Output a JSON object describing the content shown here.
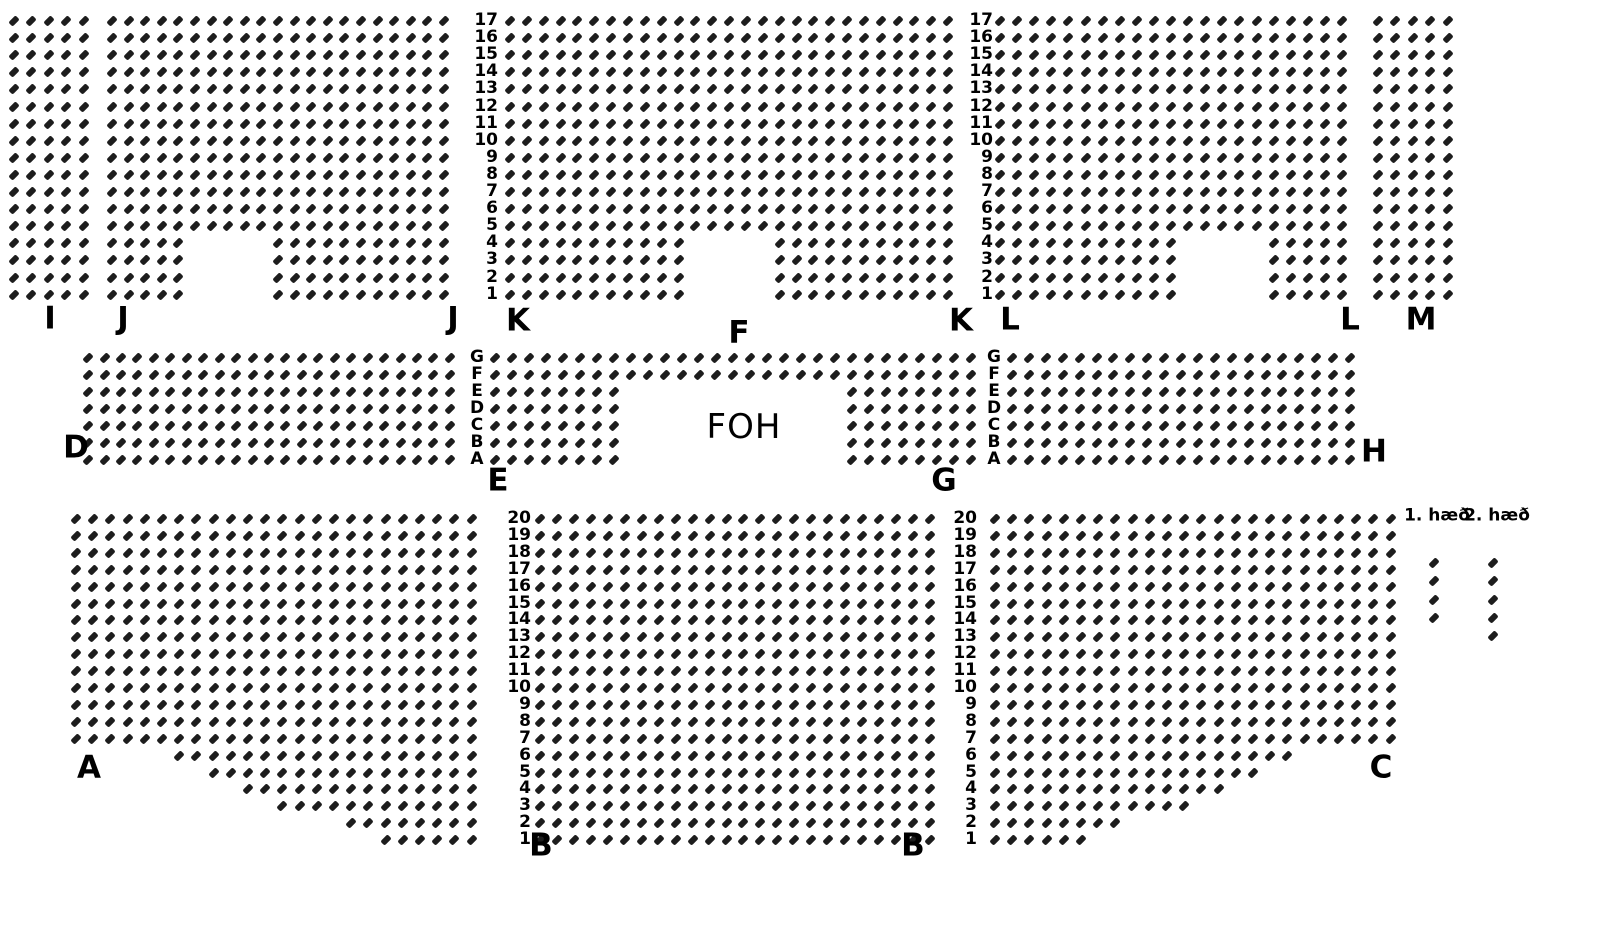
{
  "page": {
    "kind": "venue-seating-chart",
    "background_color": "#ffffff",
    "text_color": "#000000",
    "seat_color": "#1d1d1d"
  },
  "seat_map": {
    "seat_style": {
      "w": 10,
      "h": 6,
      "rotation_deg": -45
    },
    "sections": [
      {
        "name": "I",
        "x": 14,
        "y": 21,
        "cols": 5,
        "rows": 17,
        "dx": 17.4,
        "dy": 17.1,
        "gaps": []
      },
      {
        "name": "J",
        "x": 112,
        "y": 21,
        "cols": 21,
        "rows": 17,
        "dx": 16.6,
        "dy": 17.1,
        "gaps": [
          {
            "r0": 13,
            "r1": 16,
            "c0": 5,
            "c1": 9
          }
        ]
      },
      {
        "name": "K-F",
        "x": 510,
        "y": 21,
        "cols": 27,
        "rows": 17,
        "dx": 16.85,
        "dy": 17.1,
        "gaps": [
          {
            "r0": 13,
            "r1": 16,
            "c0": 11,
            "c1": 15
          }
        ]
      },
      {
        "name": "L",
        "x": 1000,
        "y": 21,
        "cols": 21,
        "rows": 17,
        "dx": 17.1,
        "dy": 17.1,
        "gaps": [
          {
            "r0": 13,
            "r1": 16,
            "c0": 11,
            "c1": 15
          }
        ]
      },
      {
        "name": "M",
        "x": 1378,
        "y": 21,
        "cols": 5,
        "rows": 17,
        "dx": 17.4,
        "dy": 17.1,
        "gaps": []
      },
      {
        "name": "D",
        "x": 88,
        "y": 358,
        "cols": 23,
        "rows": 7,
        "dx": 16.45,
        "dy": 17.0,
        "gaps": []
      },
      {
        "name": "E-G-center",
        "x": 495,
        "y": 358,
        "cols": 29,
        "rows": 7,
        "dx": 17.0,
        "dy": 17.0,
        "gaps": [
          {
            "r0": 2,
            "r1": 6,
            "c0": 8,
            "c1": 20
          }
        ]
      },
      {
        "name": "H",
        "x": 1012,
        "y": 358,
        "cols": 21,
        "rows": 7,
        "dx": 16.9,
        "dy": 17.0,
        "gaps": []
      },
      {
        "name": "A",
        "x": 76,
        "y": 519,
        "cols": 24,
        "rows": 20,
        "dx": 17.2,
        "dy": 16.9,
        "gaps": [
          {
            "r0": 14,
            "r1": 14,
            "c0": 0,
            "c1": 5
          },
          {
            "r0": 15,
            "r1": 15,
            "c0": 0,
            "c1": 7
          },
          {
            "r0": 16,
            "r1": 16,
            "c0": 0,
            "c1": 9
          },
          {
            "r0": 17,
            "r1": 17,
            "c0": 0,
            "c1": 11
          },
          {
            "r0": 18,
            "r1": 18,
            "c0": 0,
            "c1": 15
          },
          {
            "r0": 19,
            "r1": 19,
            "c0": 0,
            "c1": 17
          }
        ]
      },
      {
        "name": "B",
        "x": 540,
        "y": 519,
        "cols": 24,
        "rows": 20,
        "dx": 16.95,
        "dy": 16.9,
        "gaps": []
      },
      {
        "name": "C",
        "x": 995,
        "y": 519,
        "cols": 24,
        "rows": 20,
        "dx": 17.2,
        "dy": 16.9,
        "gaps": [
          {
            "r0": 14,
            "r1": 14,
            "c0": 18,
            "c1": 23
          },
          {
            "r0": 15,
            "r1": 15,
            "c0": 16,
            "c1": 23
          },
          {
            "r0": 16,
            "r1": 16,
            "c0": 14,
            "c1": 23
          },
          {
            "r0": 17,
            "r1": 17,
            "c0": 12,
            "c1": 23
          },
          {
            "r0": 18,
            "r1": 18,
            "c0": 8,
            "c1": 23
          },
          {
            "r0": 19,
            "r1": 19,
            "c0": 6,
            "c1": 23
          }
        ]
      },
      {
        "name": "legend-1-haed",
        "x": 1434,
        "y": 563,
        "cols": 1,
        "rows": 4,
        "dx": 17,
        "dy": 18.3,
        "gaps": []
      },
      {
        "name": "legend-2-haed",
        "x": 1493,
        "y": 563,
        "cols": 1,
        "rows": 5,
        "dx": 17,
        "dy": 18.3,
        "gaps": []
      }
    ],
    "row_guides": [
      {
        "id": "top-left",
        "align": "right",
        "x": 498,
        "y": 21,
        "dy": 17.1,
        "values": [
          "17",
          "16",
          "15",
          "14",
          "13",
          "12",
          "11",
          "10",
          "9",
          "8",
          "7",
          "6",
          "5",
          "4",
          "3",
          "2",
          "1"
        ]
      },
      {
        "id": "top-right",
        "align": "right",
        "x": 993,
        "y": 21,
        "dy": 17.1,
        "values": [
          "17",
          "16",
          "15",
          "14",
          "13",
          "12",
          "11",
          "10",
          "9",
          "8",
          "7",
          "6",
          "5",
          "4",
          "3",
          "2",
          "1"
        ]
      },
      {
        "id": "mid-left",
        "align": "center",
        "x": 477,
        "y": 358,
        "dy": 17.0,
        "values": [
          "G",
          "F",
          "E",
          "D",
          "C",
          "B",
          "A"
        ]
      },
      {
        "id": "mid-right",
        "align": "center",
        "x": 994,
        "y": 358,
        "dy": 17.0,
        "values": [
          "G",
          "F",
          "E",
          "D",
          "C",
          "B",
          "A"
        ]
      },
      {
        "id": "bottom-left",
        "align": "right",
        "x": 531,
        "y": 519,
        "dy": 16.9,
        "values": [
          "20",
          "19",
          "18",
          "17",
          "16",
          "15",
          "14",
          "13",
          "12",
          "11",
          "10",
          "9",
          "8",
          "7",
          "6",
          "5",
          "4",
          "3",
          "2",
          "1"
        ]
      },
      {
        "id": "bottom-right",
        "align": "right",
        "x": 977,
        "y": 519,
        "dy": 16.9,
        "values": [
          "20",
          "19",
          "18",
          "17",
          "16",
          "15",
          "14",
          "13",
          "12",
          "11",
          "10",
          "9",
          "8",
          "7",
          "6",
          "5",
          "4",
          "3",
          "2",
          "1"
        ]
      }
    ],
    "labels": [
      {
        "id": "I",
        "text": "I",
        "x": 50,
        "y": 319
      },
      {
        "id": "J-left",
        "text": "J",
        "x": 123,
        "y": 319
      },
      {
        "id": "J-right",
        "text": "J",
        "x": 453,
        "y": 319
      },
      {
        "id": "K-left",
        "text": "K",
        "x": 518,
        "y": 321
      },
      {
        "id": "F",
        "text": "F",
        "x": 739,
        "y": 333
      },
      {
        "id": "K-right",
        "text": "K",
        "x": 961,
        "y": 321
      },
      {
        "id": "L-left",
        "text": "L",
        "x": 1010,
        "y": 320
      },
      {
        "id": "L-right",
        "text": "L",
        "x": 1350,
        "y": 320
      },
      {
        "id": "M",
        "text": "M",
        "x": 1421,
        "y": 320
      },
      {
        "id": "D",
        "text": "D",
        "x": 76,
        "y": 448
      },
      {
        "id": "E",
        "text": "E",
        "x": 498,
        "y": 481
      },
      {
        "id": "FOH",
        "text": "FOH",
        "x": 744,
        "y": 427,
        "cls": "foh"
      },
      {
        "id": "G",
        "text": "G",
        "x": 944,
        "y": 481
      },
      {
        "id": "H",
        "text": "H",
        "x": 1374,
        "y": 452
      },
      {
        "id": "A",
        "text": "A",
        "x": 89,
        "y": 768
      },
      {
        "id": "B-left",
        "text": "B",
        "x": 541,
        "y": 846
      },
      {
        "id": "B-right",
        "text": "B",
        "x": 913,
        "y": 846
      },
      {
        "id": "C",
        "text": "C",
        "x": 1381,
        "y": 768
      },
      {
        "id": "legend-floor1",
        "text": "1. hæð",
        "x": 1437,
        "y": 516,
        "cls": "legend"
      },
      {
        "id": "legend-floor2",
        "text": "2. hæð",
        "x": 1497,
        "y": 516,
        "cls": "legend"
      }
    ]
  }
}
